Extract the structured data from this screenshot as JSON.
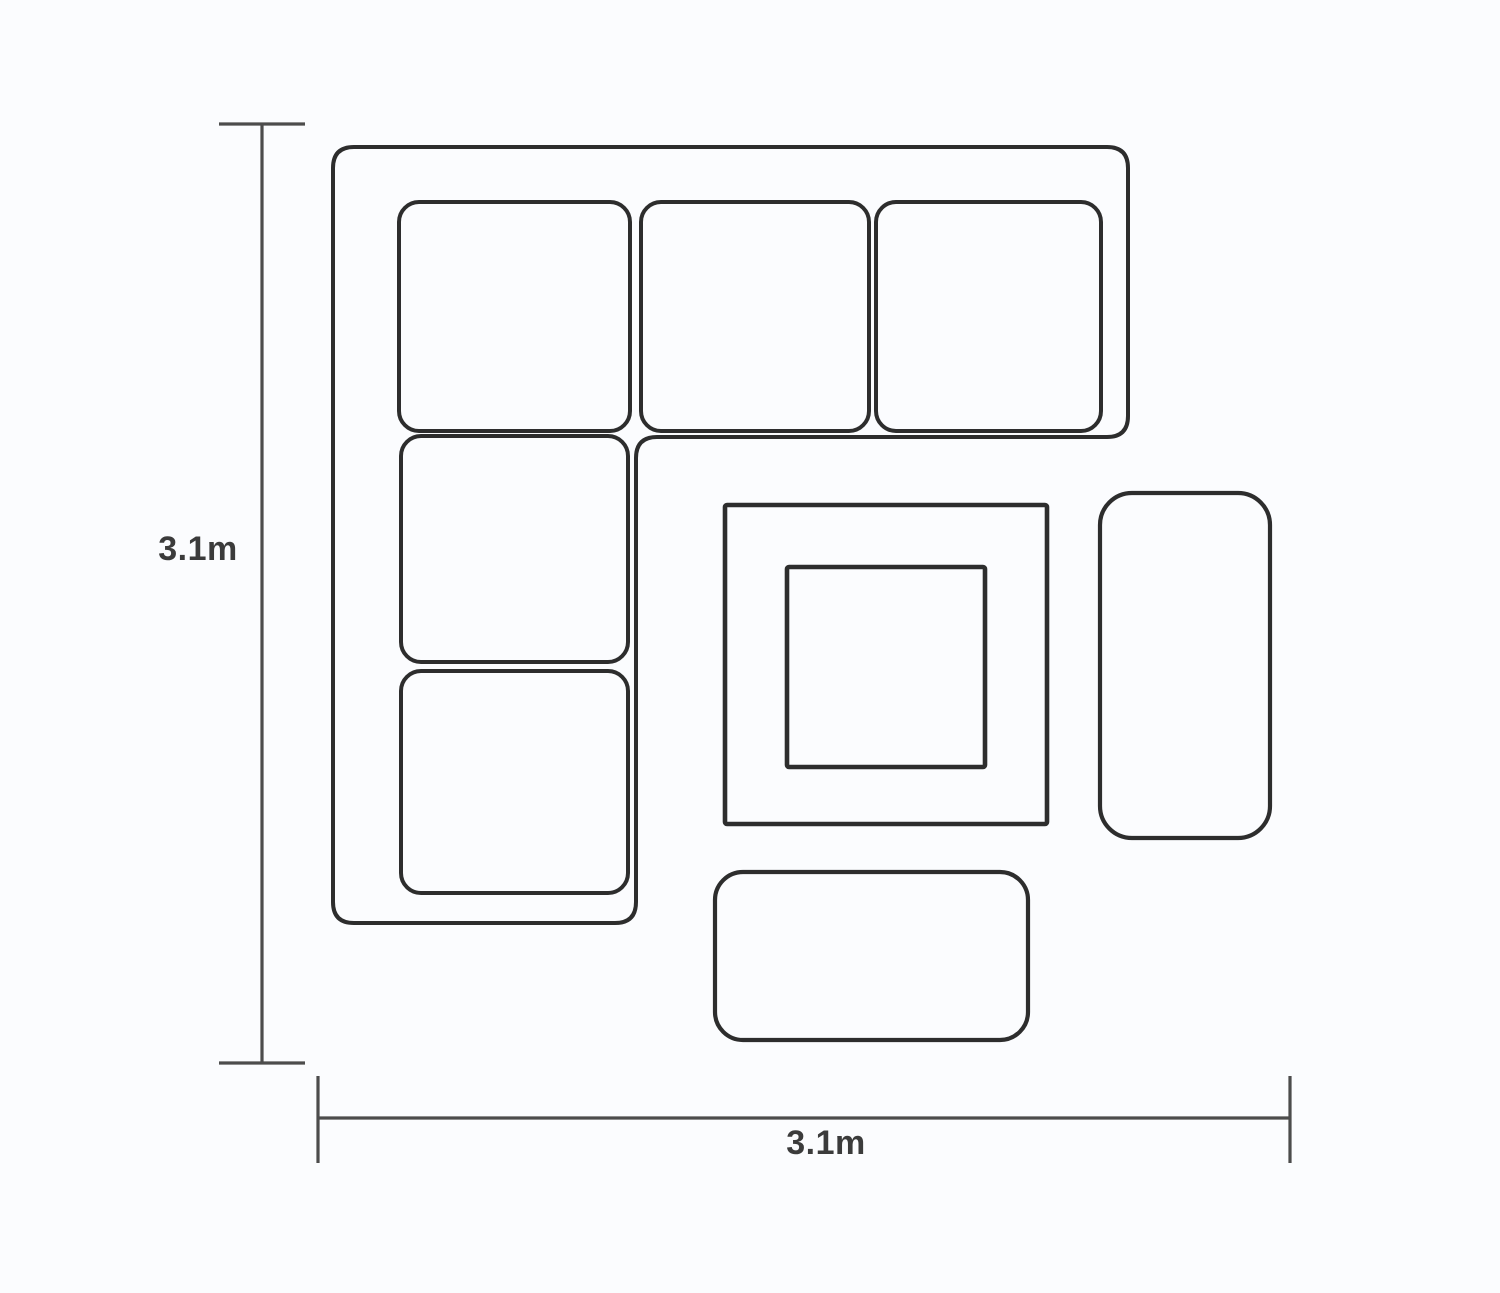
{
  "theme": {
    "background": "#fbfcfe",
    "furniture_stroke": "#2d2d2d",
    "dimension_stroke": "#4c4c4c",
    "label_color": "#3b3b3b"
  },
  "diagram": {
    "type": "furniture-floorplan-top-view",
    "vertical_dimension": {
      "label": "3.1m"
    },
    "horizontal_dimension": {
      "label": "3.1m"
    },
    "furniture": [
      {
        "name": "corner-sofa",
        "seat_cushions": 5
      },
      {
        "name": "square-table-with-inset-top"
      },
      {
        "name": "side-bench"
      },
      {
        "name": "front-bench"
      }
    ]
  }
}
